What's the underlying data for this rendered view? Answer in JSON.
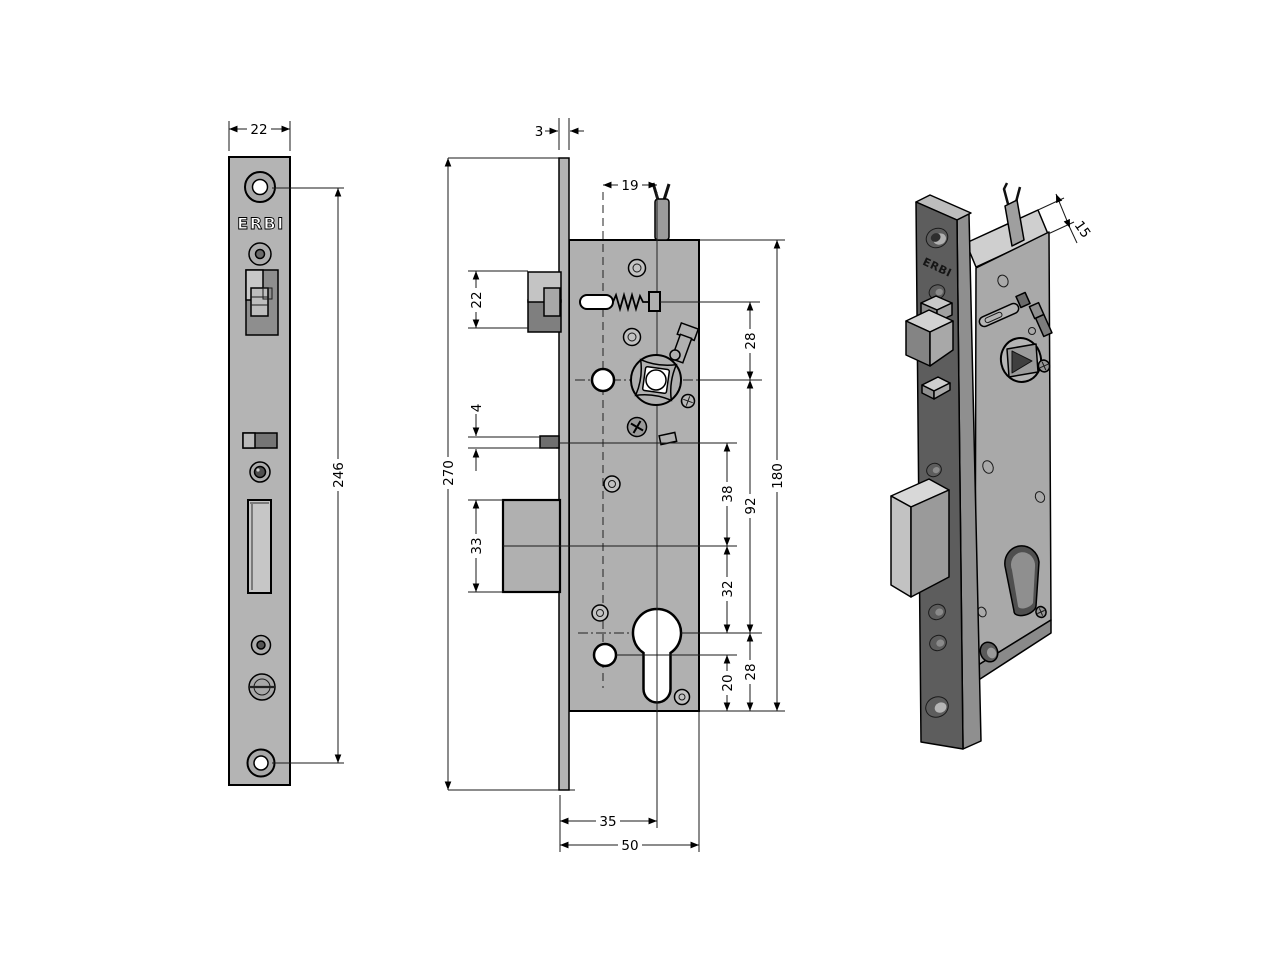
{
  "brand": "ERBI",
  "drawing": {
    "type": "mortise-lock technical drawing",
    "views": [
      "front faceplate view",
      "side section view",
      "isometric view"
    ]
  },
  "dimensions": {
    "plate_width": "22",
    "hole_spacing": "246",
    "plate_thickness": "3",
    "plate_height": "270",
    "spindle_offset": "19",
    "latch_height": "22",
    "trigger_gap": "4",
    "bolt_height": "33",
    "backset": "35",
    "case_depth": "50",
    "d38": "38",
    "d32": "32",
    "d20": "20",
    "d28_top": "28",
    "d92": "92",
    "d28_bottom": "28",
    "d180": "180",
    "case_thickness": "15"
  },
  "colors": {
    "line": "#000000",
    "metal_light": "#c8c8c8",
    "metal_mid": "#b0b0b0",
    "metal_dark": "#7a7a7a",
    "iso_plate_dark": "#5d5d5d",
    "background": "#ffffff"
  }
}
